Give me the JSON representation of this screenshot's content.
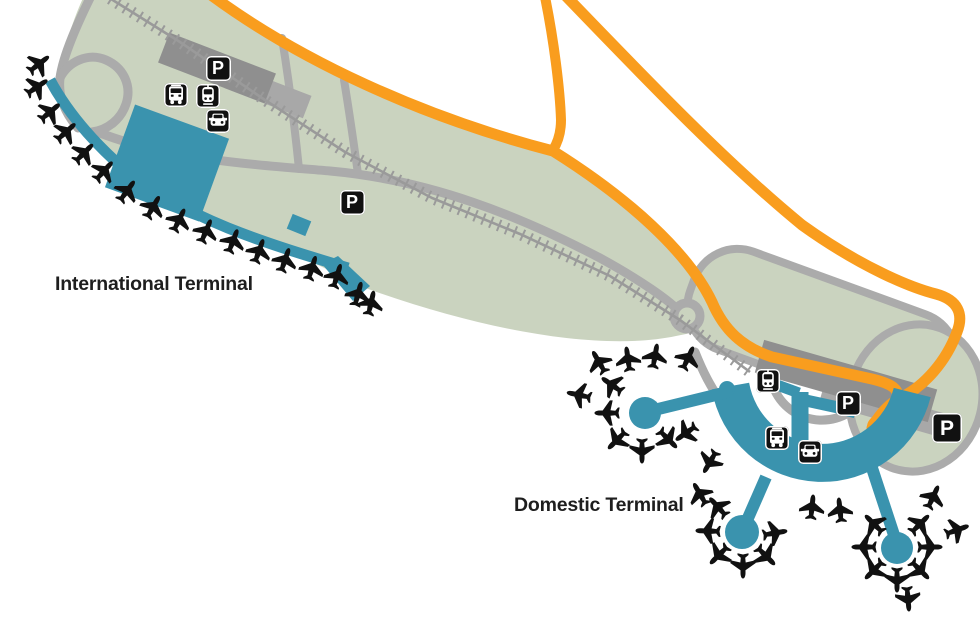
{
  "map_title": "Airport terminal map",
  "labels": {
    "international": "International Terminal",
    "domestic": "Domestic Terminal"
  },
  "colors": {
    "terrain": "#cad3bf",
    "terminal_teal": "#3a93ae",
    "road_orange": "#f99d1e",
    "road_gray": "#ababab",
    "railway_gray": "#9a9a9a",
    "building_gray": "#8f8f8f",
    "building_light": "#a8a8a8",
    "icon_bg": "#111111",
    "icon_fg": "#ffffff",
    "label_text": "#1e1e1e"
  },
  "parking_glyph": "P",
  "map_icons": [
    {
      "name": "parking-icon",
      "type": "parking",
      "x": 218,
      "y": 68,
      "size": 25
    },
    {
      "name": "bus-icon",
      "type": "bus",
      "x": 176,
      "y": 95,
      "size": 24
    },
    {
      "name": "train-icon",
      "type": "train",
      "x": 208,
      "y": 96,
      "size": 24
    },
    {
      "name": "car-icon",
      "type": "car",
      "x": 218,
      "y": 121,
      "size": 24
    },
    {
      "name": "parking-icon",
      "type": "parking",
      "x": 352,
      "y": 202,
      "size": 25
    },
    {
      "name": "train-icon",
      "type": "train",
      "x": 768,
      "y": 381,
      "size": 24
    },
    {
      "name": "parking-icon",
      "type": "parking",
      "x": 848,
      "y": 403,
      "size": 25
    },
    {
      "name": "bus-icon",
      "type": "bus",
      "x": 777,
      "y": 438,
      "size": 24
    },
    {
      "name": "car-icon",
      "type": "car",
      "x": 810,
      "y": 452,
      "size": 24
    },
    {
      "name": "parking-icon",
      "type": "parking",
      "x": 947,
      "y": 428,
      "size": 30
    }
  ],
  "planes": {
    "international": [
      {
        "x": 39,
        "y": 64,
        "r": 52
      },
      {
        "x": 37,
        "y": 87,
        "r": 56
      },
      {
        "x": 50,
        "y": 112,
        "r": 50
      },
      {
        "x": 66,
        "y": 132,
        "r": 48
      },
      {
        "x": 84,
        "y": 153,
        "r": 45
      },
      {
        "x": 104,
        "y": 171,
        "r": 42
      },
      {
        "x": 127,
        "y": 191,
        "r": 36
      },
      {
        "x": 153,
        "y": 207,
        "r": 30
      },
      {
        "x": 179,
        "y": 220,
        "r": 26
      },
      {
        "x": 206,
        "y": 231,
        "r": 23
      },
      {
        "x": 233,
        "y": 241,
        "r": 21
      },
      {
        "x": 259,
        "y": 251,
        "r": 20
      },
      {
        "x": 285,
        "y": 260,
        "r": 19
      },
      {
        "x": 312,
        "y": 268,
        "r": 17
      },
      {
        "x": 337,
        "y": 276,
        "r": 17
      },
      {
        "x": 358,
        "y": 294,
        "r": 15
      },
      {
        "x": 371,
        "y": 303,
        "r": 13
      }
    ],
    "domestic": [
      {
        "x": 612,
        "y": 385,
        "r": -55
      },
      {
        "x": 607,
        "y": 413,
        "r": -90
      },
      {
        "x": 617,
        "y": 440,
        "r": -135
      },
      {
        "x": 642,
        "y": 451,
        "r": 180
      },
      {
        "x": 668,
        "y": 439,
        "r": 135
      },
      {
        "x": 599,
        "y": 362,
        "r": -30
      },
      {
        "x": 579,
        "y": 395,
        "r": -78
      },
      {
        "x": 628,
        "y": 359,
        "r": -8
      },
      {
        "x": 655,
        "y": 356,
        "r": 10
      },
      {
        "x": 688,
        "y": 358,
        "r": 25
      },
      {
        "x": 775,
        "y": 533,
        "r": 80
      },
      {
        "x": 766,
        "y": 556,
        "r": 135
      },
      {
        "x": 743,
        "y": 566,
        "r": 180
      },
      {
        "x": 719,
        "y": 555,
        "r": -135
      },
      {
        "x": 708,
        "y": 531,
        "r": -88
      },
      {
        "x": 718,
        "y": 507,
        "r": -42
      },
      {
        "x": 700,
        "y": 494,
        "r": -30
      },
      {
        "x": 812,
        "y": 507,
        "r": 6
      },
      {
        "x": 840,
        "y": 510,
        "r": -6
      },
      {
        "x": 920,
        "y": 524,
        "r": 45
      },
      {
        "x": 930,
        "y": 547,
        "r": 90
      },
      {
        "x": 920,
        "y": 570,
        "r": 135
      },
      {
        "x": 897,
        "y": 580,
        "r": 180
      },
      {
        "x": 874,
        "y": 570,
        "r": -135
      },
      {
        "x": 864,
        "y": 547,
        "r": -90
      },
      {
        "x": 874,
        "y": 524,
        "r": -45
      },
      {
        "x": 933,
        "y": 497,
        "r": 25
      },
      {
        "x": 957,
        "y": 530,
        "r": 70
      },
      {
        "x": 908,
        "y": 599,
        "r": 175
      },
      {
        "x": 686,
        "y": 433,
        "r": -125
      },
      {
        "x": 710,
        "y": 462,
        "r": -150
      }
    ]
  }
}
